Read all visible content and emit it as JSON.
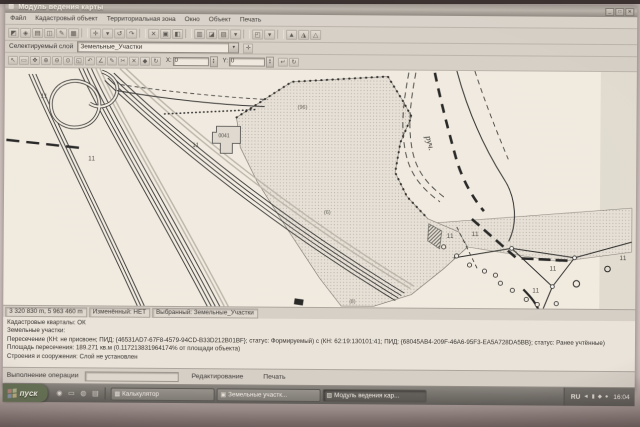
{
  "window": {
    "title": "Модуль ведения карты",
    "controls": {
      "minimize": "_",
      "maximize": "□",
      "close": "✕"
    }
  },
  "menu": {
    "items": [
      "Файл",
      "Кадастровый объект",
      "Территориальная зона",
      "Окно",
      "Объект",
      "Печать"
    ]
  },
  "icons": {
    "app": "▨",
    "chevron_down": "▾",
    "plus": "✛",
    "spin_up": "▴",
    "spin_down": "▾"
  },
  "toolbars": {
    "main_icons": [
      {
        "name": "select-parcel-icon",
        "glyph": "◩"
      },
      {
        "name": "find-object-icon",
        "glyph": "◈"
      },
      {
        "name": "layers-icon",
        "glyph": "▤"
      },
      {
        "name": "open-object-icon",
        "glyph": "◫"
      },
      {
        "name": "edit-attributes-icon",
        "glyph": "✎"
      },
      {
        "name": "table-icon",
        "glyph": "▦"
      },
      {
        "sep": true
      },
      {
        "name": "draw-contour-icon",
        "glyph": "✛"
      },
      {
        "name": "draw-options-icon",
        "glyph": "▾"
      },
      {
        "name": "undo-icon",
        "glyph": "↺"
      },
      {
        "name": "redo-icon",
        "glyph": "↷"
      },
      {
        "sep": true
      },
      {
        "name": "delete-object-icon",
        "glyph": "✕"
      },
      {
        "name": "copy-object-icon",
        "glyph": "▣"
      },
      {
        "name": "paste-object-icon",
        "glyph": "◧"
      },
      {
        "sep": true
      },
      {
        "name": "union-icon",
        "glyph": "▥"
      },
      {
        "name": "split-icon",
        "glyph": "◪"
      },
      {
        "name": "intersect-icon",
        "glyph": "▨"
      },
      {
        "name": "intersect-options-icon",
        "glyph": "▾"
      },
      {
        "sep": true
      },
      {
        "name": "topology-check-icon",
        "glyph": "◰"
      },
      {
        "name": "topology-options-icon",
        "glyph": "▾"
      },
      {
        "sep": true
      },
      {
        "name": "zoom-layer-a-icon",
        "glyph": "▲"
      },
      {
        "name": "zoom-layer-b-icon",
        "glyph": "◮"
      },
      {
        "name": "zoom-layer-c-icon",
        "glyph": "△"
      }
    ],
    "layer_selector": {
      "label": "Селектируемый слой",
      "value": "Земельные_Участки"
    },
    "edit_icons": [
      {
        "name": "pointer-icon",
        "glyph": "↖"
      },
      {
        "name": "select-area-icon",
        "glyph": "▭"
      },
      {
        "name": "pan-icon",
        "glyph": "✥"
      },
      {
        "name": "zoom-in-icon",
        "glyph": "⊕"
      },
      {
        "name": "zoom-out-icon",
        "glyph": "⊖"
      },
      {
        "name": "zoom-full-icon",
        "glyph": "⊙"
      },
      {
        "name": "zoom-rect-icon",
        "glyph": "◱"
      },
      {
        "name": "previous-view-icon",
        "glyph": "↶"
      },
      {
        "name": "ruler-icon",
        "glyph": "∠"
      },
      {
        "name": "draw-line-icon",
        "glyph": "✎"
      },
      {
        "name": "cut-node-icon",
        "glyph": "✂"
      },
      {
        "name": "delete-selection-icon",
        "glyph": "✕"
      },
      {
        "name": "save-edits-icon",
        "glyph": "◆"
      },
      {
        "name": "refresh-map-icon",
        "glyph": "↻"
      }
    ],
    "coords": {
      "x_label": "X:",
      "y_label": "Y:",
      "x_value": "0",
      "y_value": "0"
    },
    "post_icons": [
      {
        "name": "apply-coords-icon",
        "glyph": "↵"
      },
      {
        "name": "reset-coords-icon",
        "glyph": "↻"
      }
    ]
  },
  "map": {
    "labels": {
      "stream": "руч.",
      "building": "0041",
      "parcel_number_top": "(96)",
      "parcel_number_bottom": "(6)",
      "parcel_number_edge": "(8)",
      "meadow_mark": "11"
    }
  },
  "status_bar": {
    "coordinates": "3 320 830 m, 5 963 460 m",
    "modified": "Изменённый: НЕТ",
    "selected_layer": "Выбранный: Земельные_Участки"
  },
  "info_panel": {
    "lines": [
      "Кадастровые кварталы: ОК",
      "Земельные участки:",
      "Пересечение (КН: не присвоен; ПИД: {46531AD7-67F8-4579-94CD-B33D212B01BF}; статус: Формируемый) с (КН: 62:19:130101:41; ПИД: {68045AB4-209F-46A6-95F3-EA5A728DA5BB}; статус: Ранее учтённые)",
      "Площадь пересечения: 189.271 кв.м (0.117213831964174% от площади объекта)",
      "Строения и сооружения: Слой не установлен"
    ]
  },
  "operation_bar": {
    "label": "Выполнение операции",
    "edit_button": "Редактирование",
    "print_button": "Печать"
  },
  "taskbar": {
    "start_label": "пуск",
    "quick_launch": [
      {
        "name": "internet-icon",
        "glyph": "◉"
      },
      {
        "name": "folder-icon",
        "glyph": "▭"
      },
      {
        "name": "media-player-icon",
        "glyph": "◍"
      },
      {
        "name": "mail-icon",
        "glyph": "▤"
      }
    ],
    "tasks": [
      {
        "label": "Калькулятор",
        "glyph": "▦",
        "active": false
      },
      {
        "label": "Земельные участк...",
        "glyph": "▣",
        "active": false
      },
      {
        "label": "Модуль ведения кар...",
        "glyph": "▨",
        "active": true
      }
    ],
    "tray": {
      "language": "RU",
      "icons": [
        {
          "name": "volume-icon",
          "glyph": "◄"
        },
        {
          "name": "network-icon",
          "glyph": "▮"
        },
        {
          "name": "antivirus-icon",
          "glyph": "◆"
        },
        {
          "name": "scheduler-icon",
          "glyph": "●"
        }
      ],
      "clock": "16:04"
    }
  }
}
